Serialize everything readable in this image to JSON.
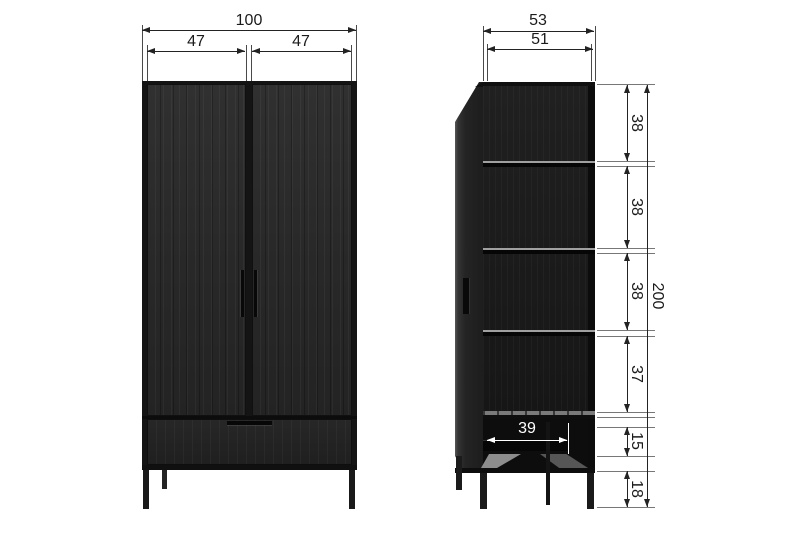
{
  "drawing": {
    "title": "two-door wardrobe dimension diagram",
    "views": {
      "front": "front view",
      "side": "side section view"
    },
    "dims": {
      "front": {
        "total_width": "100",
        "door_left": "47",
        "door_right": "47"
      },
      "side": {
        "depth_outer": "53",
        "depth_inner": "51",
        "section_1": "38",
        "section_2": "38",
        "section_3": "38",
        "section_4": "37",
        "section_5": "15",
        "section_6": "18",
        "total_height": "200",
        "bottom_width": "39"
      }
    },
    "colors": {
      "dimension_line": "#232323",
      "extension_line": "#777777",
      "cabinet_body": "#282828",
      "shelf_edge": "#a0a0a0",
      "inner_dimension_text": "#ffffff",
      "background": "#ffffff"
    }
  }
}
